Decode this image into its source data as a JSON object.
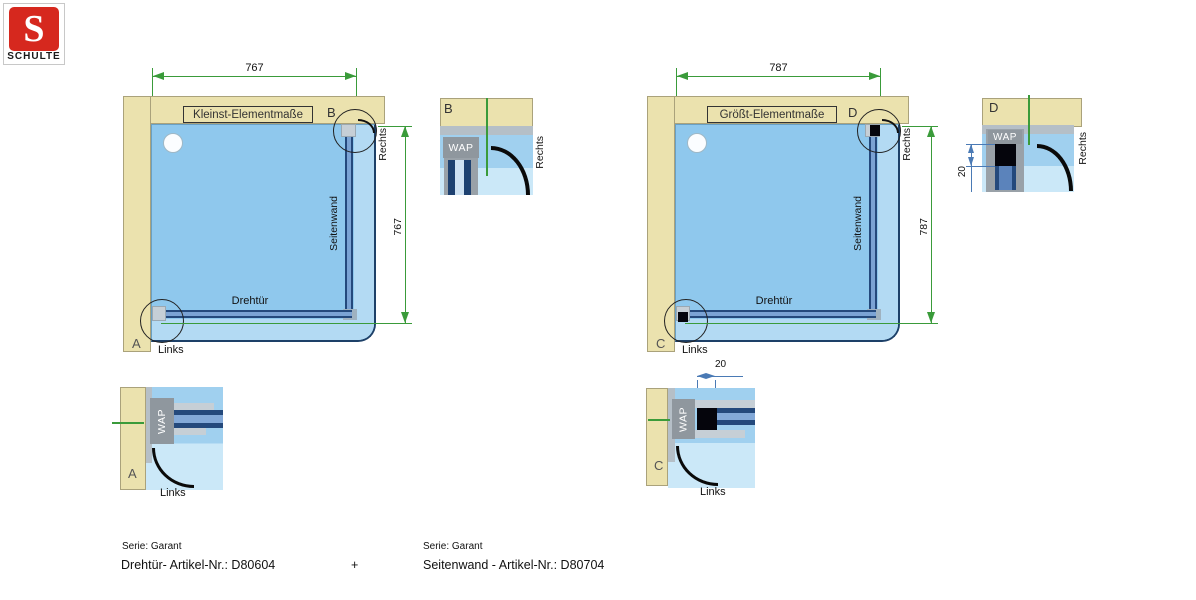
{
  "logo": {
    "letter": "S",
    "brand": "SCHULTE"
  },
  "diagram_left": {
    "title": "Kleinst-Elementmaße",
    "dim_top": "767",
    "dim_right": "767",
    "label_door": "Drehtür",
    "label_side": "Seitenwand",
    "label_right": "Rechts",
    "label_links": "Links",
    "marker_top": "B",
    "marker_bottom": "A"
  },
  "diagram_right": {
    "title": "Größt-Elementmaße",
    "dim_top": "787",
    "dim_right": "787",
    "label_door": "Drehtür",
    "label_side": "Seitenwand",
    "label_right": "Rechts",
    "label_links": "Links",
    "marker_top": "D",
    "marker_bottom": "C"
  },
  "detail_b": {
    "label": "B",
    "wap": "WAP",
    "side": "Rechts"
  },
  "detail_d": {
    "label": "D",
    "wap": "WAP",
    "side": "Rechts",
    "dim": "20"
  },
  "detail_a": {
    "label": "A",
    "wap": "WAP",
    "caption": "Links"
  },
  "detail_c": {
    "label": "C",
    "wap": "WAP",
    "caption": "Links",
    "dim": "20"
  },
  "footer": {
    "left_serie": "Serie: Garant",
    "left_article": "Drehtür- Artikel-Nr.: D80604",
    "plus": "+",
    "right_serie": "Serie: Garant",
    "right_article": "Seitenwand - Artikel-Nr.: D80704"
  },
  "colors": {
    "brand_red": "#d6281e",
    "wall_tan": "#ebe2ae",
    "tray_blue": "#8fc8ed",
    "profile_navy": "#24497c",
    "dimension_green": "#3a9b3a",
    "detail_dim_blue": "#4a7ab5"
  }
}
